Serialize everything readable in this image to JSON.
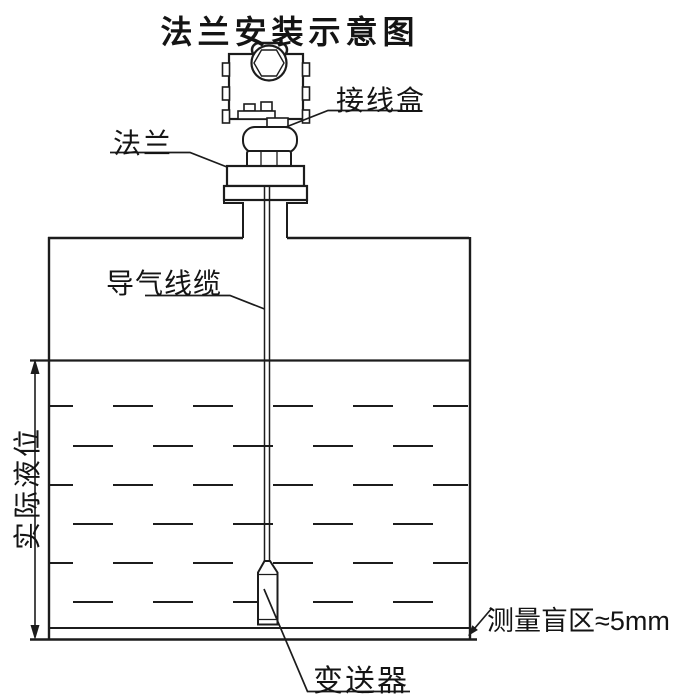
{
  "title": "法兰安装示意图",
  "labels": {
    "junction_box": "接线盒",
    "flange": "法兰",
    "vent_cable": "导气线缆",
    "actual_level": "实际液位",
    "blind_zone": "测量盲区≈5mm",
    "transmitter": "变送器"
  },
  "colors": {
    "line": "#1c1c1c",
    "background": "#ffffff"
  }
}
